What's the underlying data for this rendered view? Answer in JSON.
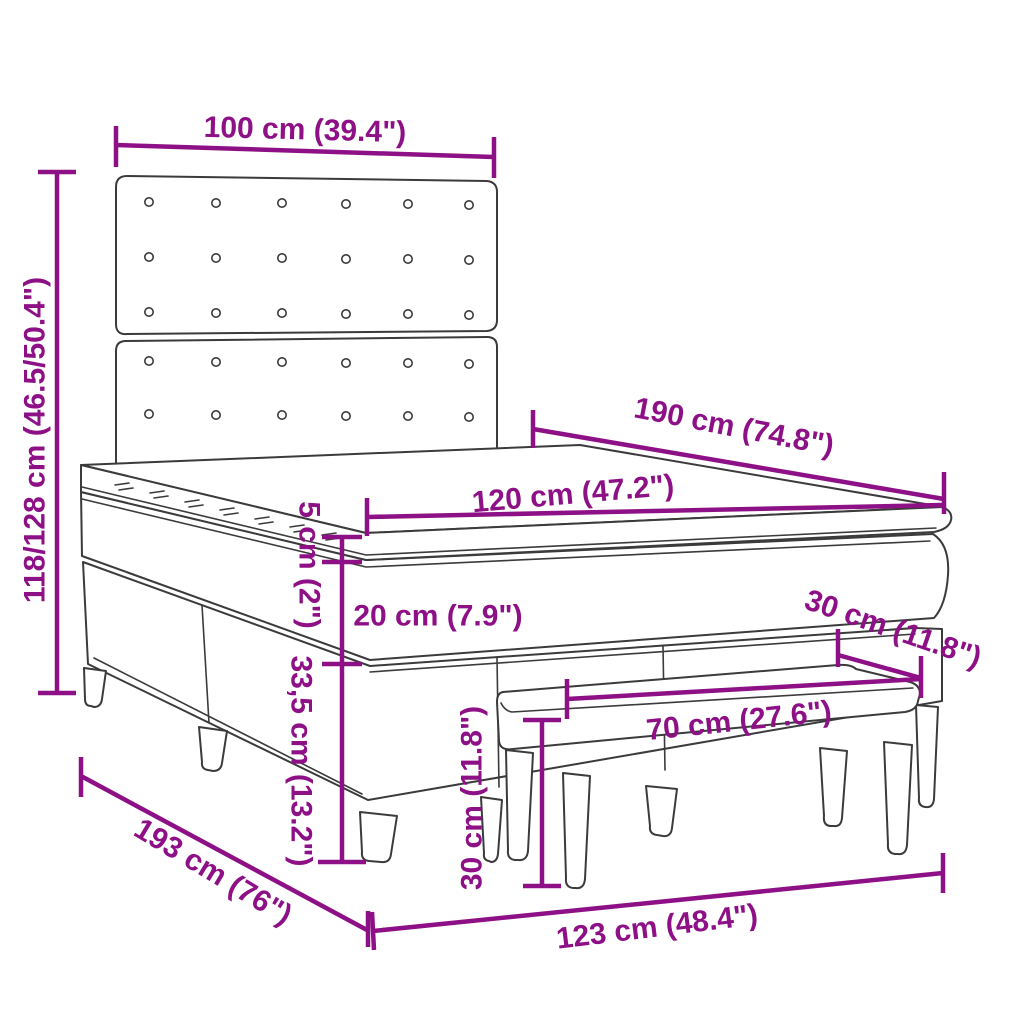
{
  "diagram": {
    "subject": "box spring bed with tufted headboard, mattress topper and upholstered bench",
    "style": "technical line drawing with dimension annotations",
    "colors": {
      "dimension_annotations": "#8E1086",
      "line_art": "#3B3B3B",
      "background": "#FFFFFF"
    },
    "labels": {
      "headboard_width": "100 cm (39.4\")",
      "overall_height": "118/128 cm (46.5/50.4\")",
      "bed_length": "190 cm (74.8\")",
      "bed_width": "120 cm (47.2\")",
      "topper_thickness": "5 cm (2\")",
      "mattress_thickness": "20 cm (7.9\")",
      "base_height": "33,5 cm (13.2\")",
      "bench_depth": "30 cm (11.8\")",
      "bench_length": "70 cm (27.6\")",
      "bench_leg_height": "30 cm (11.8\")",
      "floor_length": "193 cm (76\")",
      "floor_width": "123 cm (48.4\")"
    }
  }
}
